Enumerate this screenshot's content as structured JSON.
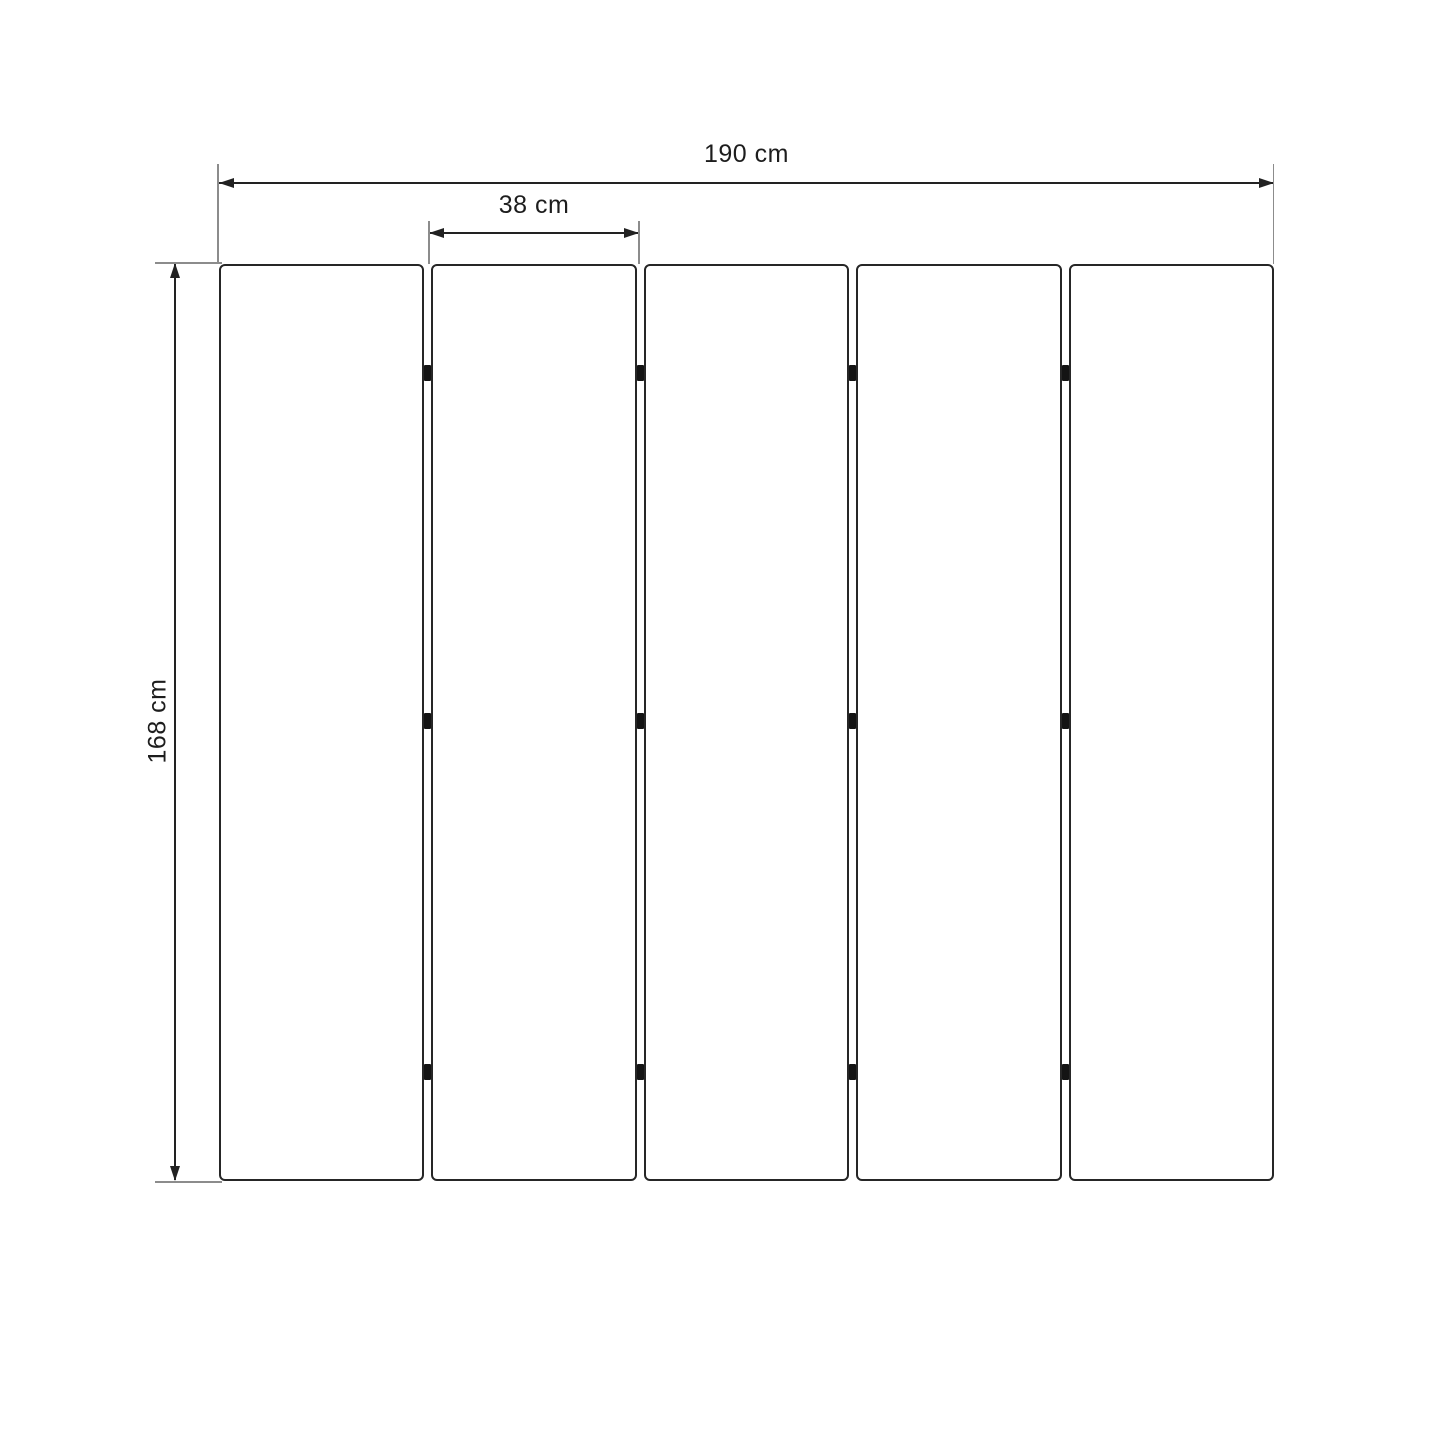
{
  "diagram": {
    "labels": {
      "total_width": "190 cm",
      "panel_width": "38 cm",
      "height": "168 cm"
    },
    "panel_count": 5,
    "hinge_columns": 4,
    "hinge_rows": 3,
    "colors": {
      "background": "#ffffff",
      "panel_border": "#262626",
      "dimension_line": "#222222",
      "extension_line": "#8c8c8c",
      "hinge": "#141414",
      "text": "#1d1d1d"
    }
  }
}
